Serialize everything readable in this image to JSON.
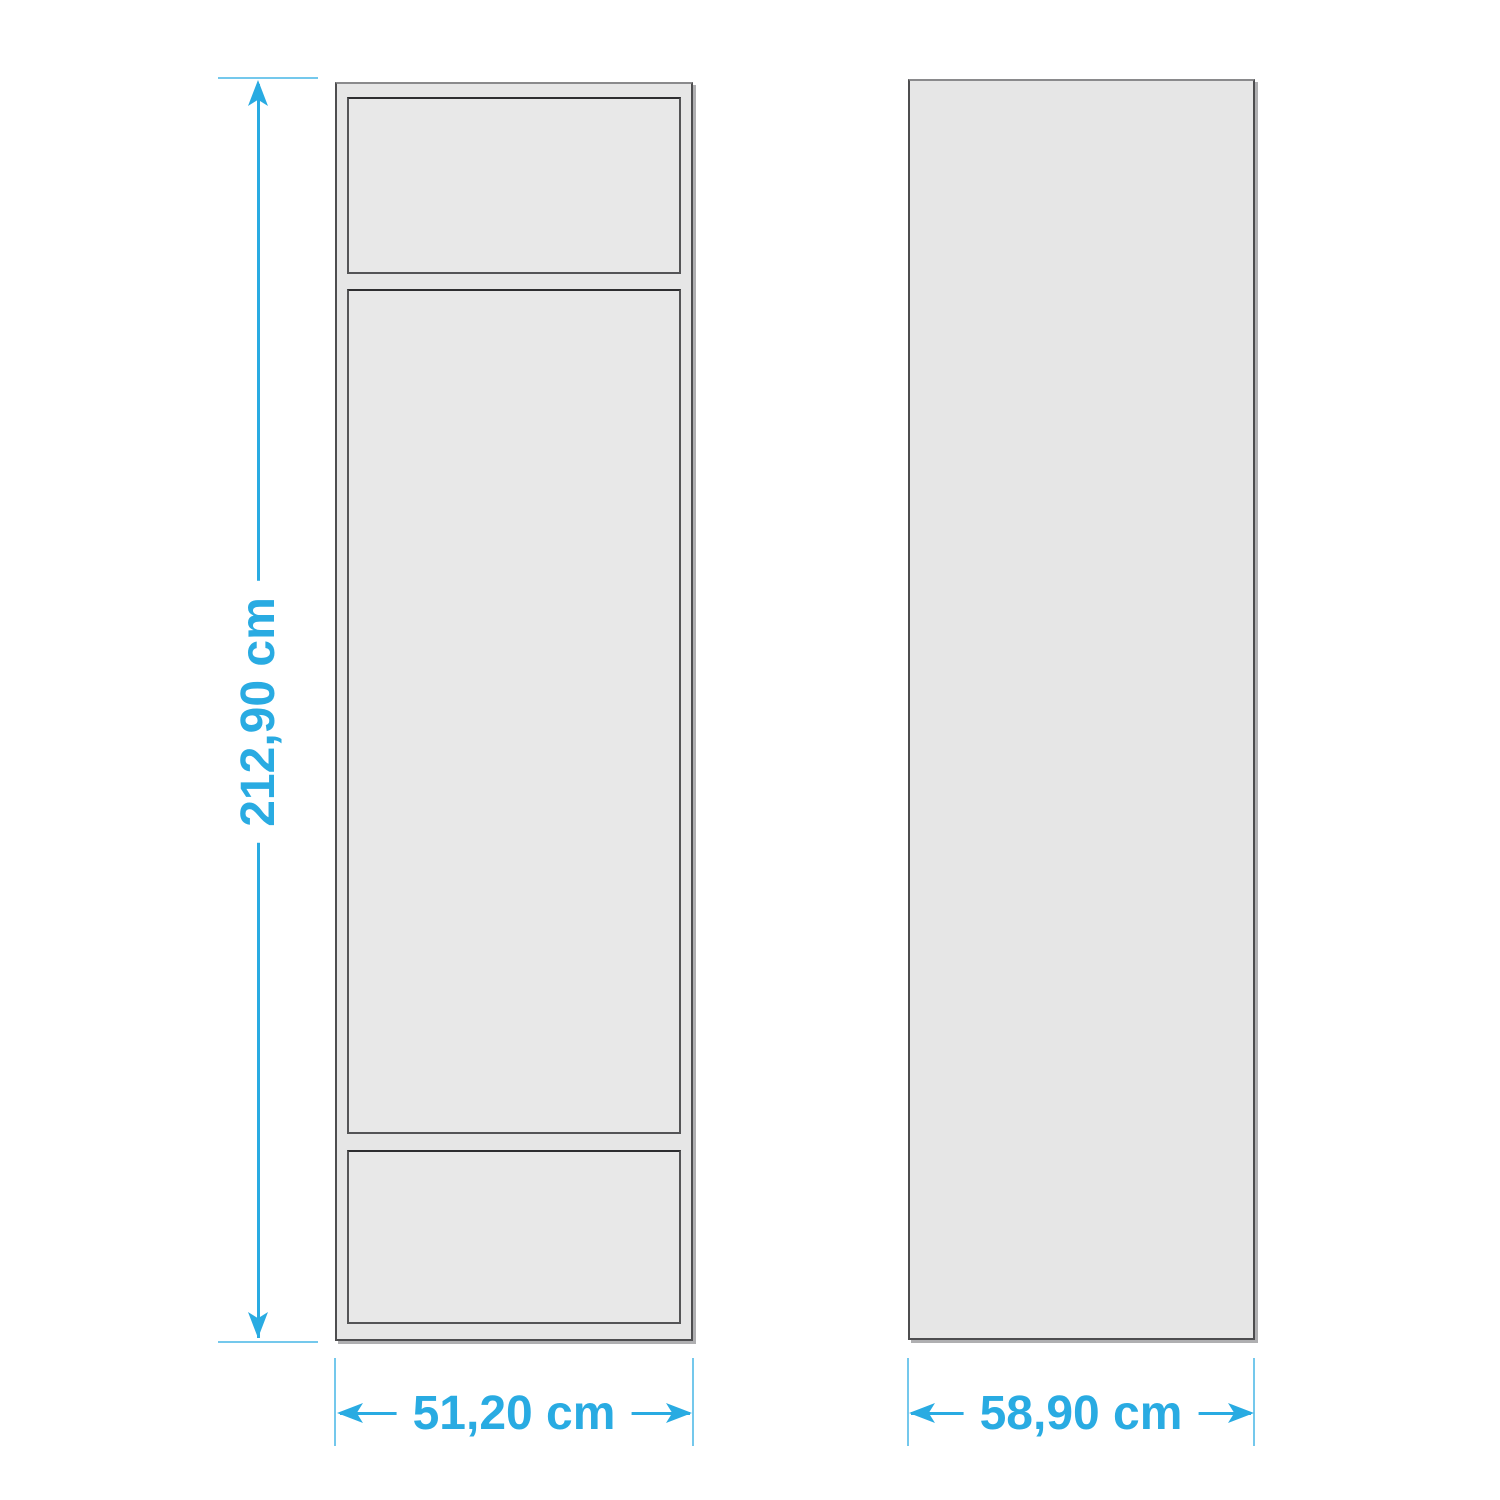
{
  "dimensions": {
    "height": {
      "label": "212,90 cm"
    },
    "front_width": {
      "label": "51,20 cm"
    },
    "side_width": {
      "label": "58,90 cm"
    }
  },
  "colors": {
    "dimension_accent": "#29ABE2",
    "figure_fill": "#E6E6E6",
    "figure_border": "#4D4D4F",
    "shadow_gray": "#6D6E71"
  }
}
